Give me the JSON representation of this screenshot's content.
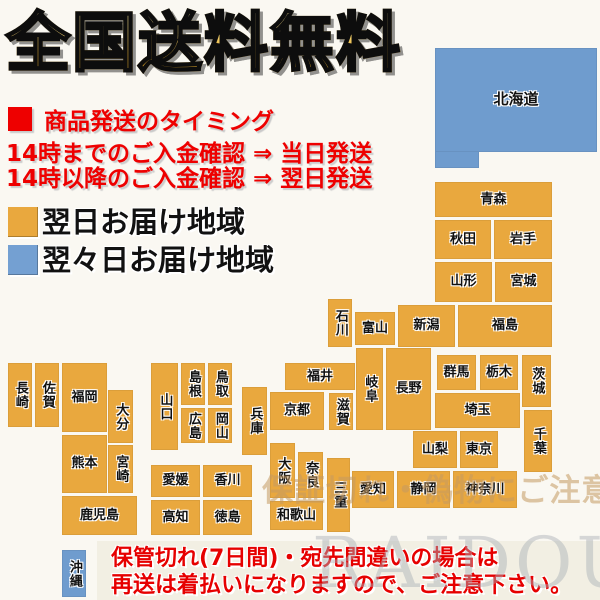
{
  "title": "全国送料無料",
  "shipping_info": {
    "heading": "商品発送のタイミング",
    "line1": "14時までのご入金確認 ⇒ 当日発送",
    "line2": "14時以降のご入金確認 ⇒ 翌日発送"
  },
  "legend": {
    "next_day": {
      "label": "翌日お届け地域",
      "color": "#E9A83E"
    },
    "two_day": {
      "label": "翌々日お届け地域",
      "color": "#74A0D2"
    }
  },
  "map": {
    "colors": {
      "orange": "#E9A83E",
      "blue": "#6F9CCE"
    },
    "blocks": [
      {
        "label": "北海道",
        "x": 435,
        "y": 48,
        "w": 162,
        "h": 104,
        "c": "blue",
        "fs": 15
      },
      {
        "label": "青森",
        "x": 435,
        "y": 182,
        "w": 117,
        "h": 35,
        "c": "orange"
      },
      {
        "label": "秋田",
        "x": 435,
        "y": 220,
        "w": 56,
        "h": 39,
        "c": "orange"
      },
      {
        "label": "岩手",
        "x": 494,
        "y": 220,
        "w": 58,
        "h": 39,
        "c": "orange"
      },
      {
        "label": "山形",
        "x": 435,
        "y": 262,
        "w": 57,
        "h": 40,
        "c": "orange"
      },
      {
        "label": "宮城",
        "x": 495,
        "y": 262,
        "w": 57,
        "h": 40,
        "c": "orange"
      },
      {
        "label": "新潟",
        "x": 398,
        "y": 305,
        "w": 57,
        "h": 42,
        "c": "orange"
      },
      {
        "label": "福島",
        "x": 458,
        "y": 305,
        "w": 94,
        "h": 42,
        "c": "orange"
      },
      {
        "label": "石川",
        "x": 328,
        "y": 299,
        "w": 24,
        "h": 48,
        "c": "orange",
        "v": 1
      },
      {
        "label": "富山",
        "x": 355,
        "y": 312,
        "w": 40,
        "h": 33,
        "c": "orange"
      },
      {
        "label": "群馬",
        "x": 437,
        "y": 355,
        "w": 39,
        "h": 35,
        "c": "orange"
      },
      {
        "label": "栃木",
        "x": 480,
        "y": 355,
        "w": 38,
        "h": 35,
        "c": "orange"
      },
      {
        "label": "茨城",
        "x": 522,
        "y": 355,
        "w": 29,
        "h": 52,
        "c": "orange",
        "v": 1
      },
      {
        "label": "埼玉",
        "x": 435,
        "y": 393,
        "w": 85,
        "h": 35,
        "c": "orange"
      },
      {
        "label": "長野",
        "x": 386,
        "y": 348,
        "w": 45,
        "h": 82,
        "c": "orange"
      },
      {
        "label": "岐阜",
        "x": 356,
        "y": 348,
        "w": 27,
        "h": 82,
        "c": "orange",
        "v": 1
      },
      {
        "label": "山梨",
        "x": 413,
        "y": 431,
        "w": 44,
        "h": 37,
        "c": "orange"
      },
      {
        "label": "東京",
        "x": 460,
        "y": 431,
        "w": 38,
        "h": 37,
        "c": "orange"
      },
      {
        "label": "千葉",
        "x": 524,
        "y": 410,
        "w": 28,
        "h": 62,
        "c": "orange",
        "v": 1
      },
      {
        "label": "神奈川",
        "x": 453,
        "y": 471,
        "w": 64,
        "h": 37,
        "c": "orange"
      },
      {
        "label": "静岡",
        "x": 397,
        "y": 471,
        "w": 53,
        "h": 37,
        "c": "orange"
      },
      {
        "label": "愛知",
        "x": 352,
        "y": 471,
        "w": 42,
        "h": 37,
        "c": "orange"
      },
      {
        "label": "福井",
        "x": 285,
        "y": 363,
        "w": 70,
        "h": 27,
        "c": "orange"
      },
      {
        "label": "滋賀",
        "x": 329,
        "y": 393,
        "w": 24,
        "h": 37,
        "c": "orange",
        "v": 1
      },
      {
        "label": "京都",
        "x": 270,
        "y": 392,
        "w": 54,
        "h": 38,
        "c": "orange"
      },
      {
        "label": "兵庫",
        "x": 242,
        "y": 387,
        "w": 25,
        "h": 68,
        "c": "orange",
        "v": 1
      },
      {
        "label": "大阪",
        "x": 270,
        "y": 443,
        "w": 25,
        "h": 55,
        "c": "orange",
        "v": 1
      },
      {
        "label": "奈良",
        "x": 298,
        "y": 452,
        "w": 25,
        "h": 46,
        "c": "orange",
        "v": 1
      },
      {
        "label": "三重",
        "x": 327,
        "y": 458,
        "w": 23,
        "h": 74,
        "c": "orange",
        "v": 1
      },
      {
        "label": "和歌山",
        "x": 270,
        "y": 501,
        "w": 53,
        "h": 29,
        "c": "orange"
      },
      {
        "label": "島根",
        "x": 181,
        "y": 363,
        "w": 24,
        "h": 42,
        "c": "orange",
        "v": 1
      },
      {
        "label": "鳥取",
        "x": 208,
        "y": 363,
        "w": 24,
        "h": 42,
        "c": "orange",
        "v": 1
      },
      {
        "label": "広島",
        "x": 181,
        "y": 408,
        "w": 24,
        "h": 35,
        "c": "orange",
        "v": 1
      },
      {
        "label": "岡山",
        "x": 208,
        "y": 408,
        "w": 24,
        "h": 35,
        "c": "orange",
        "v": 1
      },
      {
        "label": "山口",
        "x": 151,
        "y": 363,
        "w": 27,
        "h": 87,
        "c": "orange",
        "v": 1
      },
      {
        "label": "愛媛",
        "x": 151,
        "y": 465,
        "w": 49,
        "h": 32,
        "c": "orange"
      },
      {
        "label": "香川",
        "x": 203,
        "y": 465,
        "w": 49,
        "h": 32,
        "c": "orange"
      },
      {
        "label": "高知",
        "x": 151,
        "y": 500,
        "w": 49,
        "h": 35,
        "c": "orange"
      },
      {
        "label": "徳島",
        "x": 203,
        "y": 500,
        "w": 49,
        "h": 35,
        "c": "orange"
      },
      {
        "label": "長崎",
        "x": 8,
        "y": 363,
        "w": 24,
        "h": 64,
        "c": "orange",
        "v": 1
      },
      {
        "label": "佐賀",
        "x": 35,
        "y": 363,
        "w": 24,
        "h": 64,
        "c": "orange",
        "v": 1
      },
      {
        "label": "福岡",
        "x": 62,
        "y": 363,
        "w": 45,
        "h": 69,
        "c": "orange"
      },
      {
        "label": "大分",
        "x": 108,
        "y": 390,
        "w": 25,
        "h": 53,
        "c": "orange",
        "v": 1
      },
      {
        "label": "熊本",
        "x": 62,
        "y": 435,
        "w": 45,
        "h": 58,
        "c": "orange"
      },
      {
        "label": "宮崎",
        "x": 108,
        "y": 445,
        "w": 25,
        "h": 48,
        "c": "orange",
        "v": 1
      },
      {
        "label": "鹿児島",
        "x": 62,
        "y": 496,
        "w": 75,
        "h": 39,
        "c": "orange"
      },
      {
        "label": "沖縄",
        "x": 62,
        "y": 550,
        "w": 24,
        "h": 47,
        "c": "blue",
        "v": 1
      }
    ],
    "shapes": [
      {
        "x": 435,
        "y": 150,
        "w": 44,
        "h": 18,
        "c": "blue"
      }
    ]
  },
  "warning": {
    "line1": "保管切れ(7日間)・宛先間違いの場合は",
    "line2": "再送は着払いになりますので、ご注意下さい。"
  },
  "watermarks": {
    "diagonal": "保証切れ・偽物にご注意下さい",
    "brand": "RAIDOU"
  }
}
